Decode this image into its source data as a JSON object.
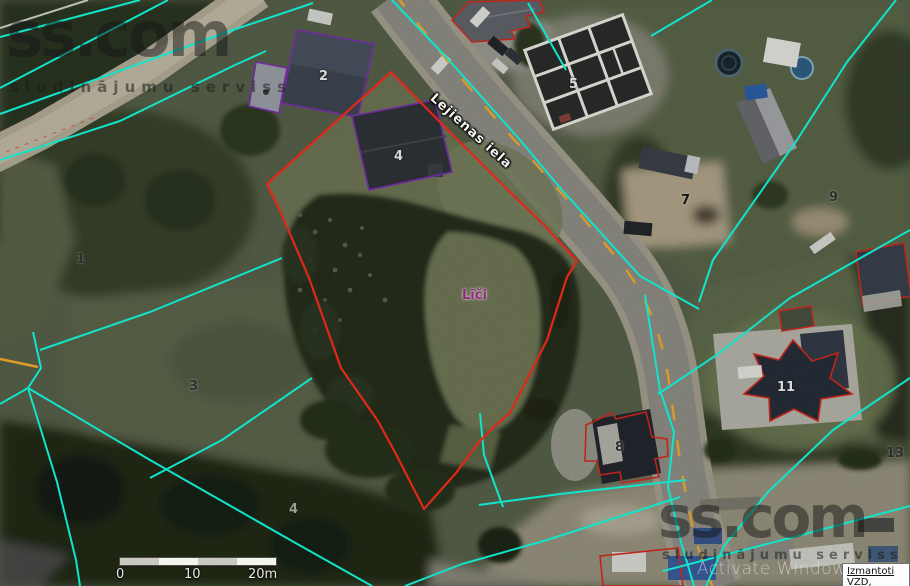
{
  "map": {
    "street_label": "Lejienas iela",
    "place_label": "Līči",
    "parcel_labels": [
      {
        "text": "1"
      },
      {
        "text": "2"
      },
      {
        "text": "3"
      },
      {
        "text": "4"
      },
      {
        "text": "5"
      },
      {
        "text": "7"
      },
      {
        "text": "8"
      },
      {
        "text": "9"
      },
      {
        "text": "11"
      },
      {
        "text": "13"
      },
      {
        "text": "4"
      }
    ],
    "colors": {
      "parcel_boundary_cyan": "#12e3cb",
      "highlight_parcel_red": "#e02818",
      "building_outline_purple": "#7d2fb5",
      "road_marking_orange": "#d6992e",
      "place_label_magenta": "#8e2c7e"
    }
  },
  "branding": {
    "logo": "ss.com",
    "tagline": "sludinājumu serviss"
  },
  "overlay": {
    "activation_watermark": "Activate Windows"
  },
  "attribution": {
    "label": "Izmantoti VZD,"
  },
  "scale_bar": {
    "ticks": [
      "0",
      "10",
      "20m"
    ]
  }
}
